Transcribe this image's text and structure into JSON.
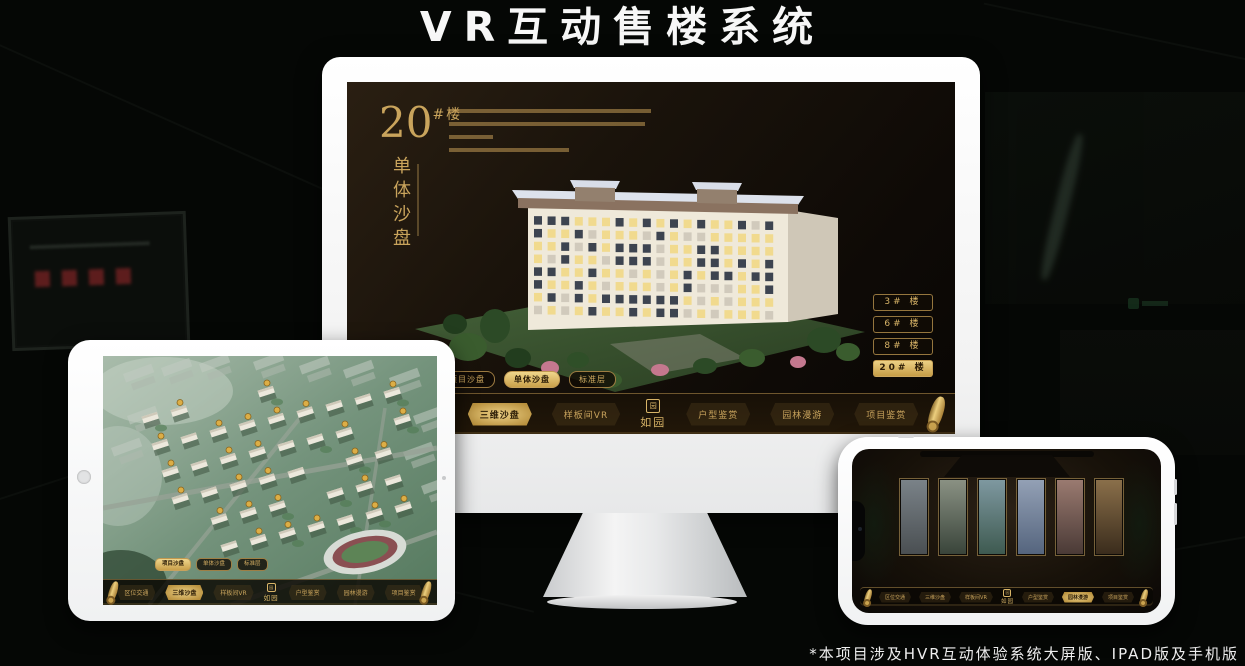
{
  "title": "VR互动售楼系统",
  "footnote": "*本项目涉及HVR互动体验系统大屏版、IPAD版及手机版",
  "brand": {
    "logo_text": "如园",
    "logo_seal": "园"
  },
  "colors": {
    "gold": "#c9a45c",
    "gold_active": "#ddb469",
    "screen_bg": "#17100a"
  },
  "monitor": {
    "headline": {
      "number": "20",
      "unit": "#楼",
      "subtitle_vertical": "单体沙盘"
    },
    "floor_buttons": [
      {
        "label": "3# 楼",
        "active": false
      },
      {
        "label": "6# 楼",
        "active": false
      },
      {
        "label": "8# 楼",
        "active": false
      },
      {
        "label": "20# 楼",
        "active": true
      }
    ],
    "sub_tabs": [
      {
        "label": "项目沙盘",
        "active": false
      },
      {
        "label": "单体沙盘",
        "active": true
      },
      {
        "label": "标准层",
        "active": false
      }
    ],
    "menu_left": [
      {
        "label": "区位交通",
        "active": false
      },
      {
        "label": "三维沙盘",
        "active": true
      },
      {
        "label": "样板间VR",
        "active": false
      }
    ],
    "menu_right": [
      {
        "label": "户型鉴赏",
        "active": false
      },
      {
        "label": "园林漫游",
        "active": false
      },
      {
        "label": "项目鉴赏",
        "active": false
      }
    ]
  },
  "tablet": {
    "sub_tabs": [
      {
        "label": "项目沙盘",
        "active": true
      },
      {
        "label": "单体沙盘",
        "active": false
      },
      {
        "label": "标准层",
        "active": false
      }
    ],
    "menu_left": [
      {
        "label": "区位交通",
        "active": false
      },
      {
        "label": "三维沙盘",
        "active": true
      },
      {
        "label": "样板间VR",
        "active": false
      }
    ],
    "menu_right": [
      {
        "label": "户型鉴赏",
        "active": false
      },
      {
        "label": "园林漫游",
        "active": false
      },
      {
        "label": "项目鉴赏",
        "active": false
      }
    ]
  },
  "phone": {
    "menu_left": [
      {
        "label": "区位交通",
        "active": false
      },
      {
        "label": "三维沙盘",
        "active": false
      },
      {
        "label": "样板间VR",
        "active": false
      }
    ],
    "menu_right": [
      {
        "label": "户型鉴赏",
        "active": false
      },
      {
        "label": "园林漫游",
        "active": true
      },
      {
        "label": "项目鉴赏",
        "active": false
      }
    ]
  }
}
